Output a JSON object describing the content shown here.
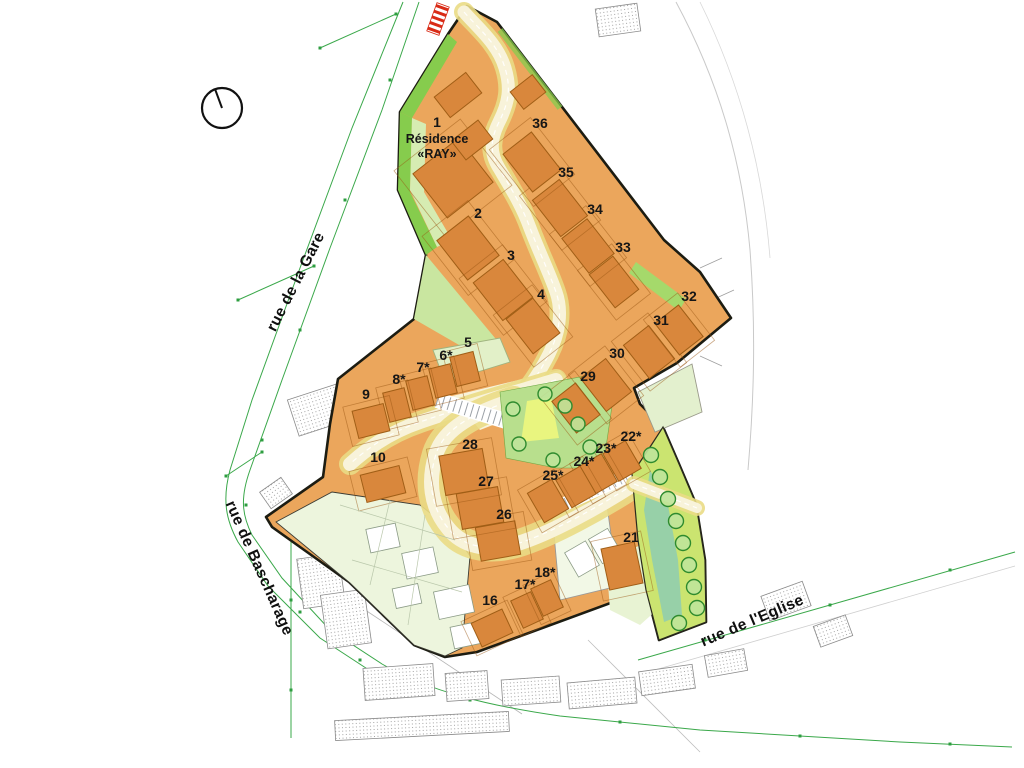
{
  "map": {
    "colors": {
      "lot_fill": "#EBA65C",
      "building_fill": "#D9873C",
      "building_stroke": "#A05E16",
      "boundary": "#1c1c12",
      "road_edge": "#EADB85",
      "road_fill": "#F8F3DA",
      "green_bright": "#86CC4D",
      "green_light": "#C9E6A0",
      "green_central": "#B8DF8D",
      "green_yellow_patch": "#E9F57F",
      "strip_fill": "#CBE470",
      "strip_teal": "#8FCDAF",
      "faint_lot": "#EDF5DD",
      "marker_red": "#D92B16",
      "survey_green": "#3aa84a"
    },
    "compass": {
      "cx": 222,
      "cy": 108,
      "r": 20,
      "hand_x": 215,
      "hand_y": 89
    },
    "entrance_marker": {
      "x": 438,
      "y": 19,
      "w": 13,
      "h": 30,
      "rot": 20,
      "stripes": 5
    },
    "residence": {
      "lot": "1",
      "line1": "Résidence",
      "line2": "«RAY»",
      "x": 437,
      "y1": 143,
      "y2": 158
    },
    "streets": [
      {
        "id": "gare",
        "name": "rue de la Gare",
        "x": 300,
        "y": 284,
        "rot": -63
      },
      {
        "id": "bascharage",
        "name": "rue de Bascharage",
        "x": 255,
        "y": 570,
        "rot": 66
      },
      {
        "id": "eglise",
        "name": "rue de l'Eglise",
        "x": 754,
        "y": 625,
        "rot": -23
      }
    ],
    "boundary": "467,6 497,22 664,240 700,272 731,318 677,363 634,388 640,404 663,427 679,464 696,504 705,560 706,622 659,640 646,590 477,652 445,657 414,645 349,582 272,527 266,517 323,477 330,424 338,379 414,319 426,255 398,190 400,112 448,34",
    "plaza": "452,396 560,370 578,392 480,430",
    "roads": [
      {
        "d": "M464,12 C478,28 498,44 505,68 C511,88 509,102 499,122 C491,138 489,152 499,168 C512,190 522,206 530,228 C540,254 549,272 556,292 C563,312 559,334 549,354 C541,370 532,384 520,398",
        "w1": 16,
        "w2": 11,
        "over": false
      },
      {
        "d": "M556,380 C510,394 460,408 420,422 C396,430 372,444 350,464",
        "w1": 18,
        "w2": 12,
        "over": false
      },
      {
        "d": "M514,400 C476,412 444,428 436,454 C428,480 430,506 448,528 C462,546 486,552 516,544 C550,534 600,506 634,484",
        "w1": 24,
        "w2": 13,
        "over": false
      },
      {
        "d": "M634,484 L697,508",
        "w1": 12,
        "w2": 8,
        "over": true
      }
    ],
    "greens": [
      {
        "pts": "400,112 398,190 426,255 437,247 410,192 412,118",
        "fill": "#86CC4D"
      },
      {
        "pts": "448,34 400,112 412,118 457,42",
        "fill": "#86CC4D"
      },
      {
        "pts": "412,118 410,190 437,247 452,240 424,192 426,124",
        "fill": "#D6ECB2"
      },
      {
        "pts": "426,255 505,350 492,364 414,319",
        "fill": "#C9E6A0"
      },
      {
        "pts": "636,262 686,299 679,311 629,273",
        "fill": "#A5D96B"
      },
      {
        "pts": "433,350 500,338 510,362 445,382",
        "fill": "#E2F0C8",
        "stroke": "#9fb37f"
      },
      {
        "pts": "606,558 655,540 668,600 640,625 610,610",
        "fill": "#E8F3D3"
      },
      {
        "pts": "638,392 692,364 702,412 655,432",
        "fill": "#E3F0CE",
        "stroke": "#9a9a8a"
      },
      {
        "pts": "276,522 332,492 420,505 452,530 470,556 462,648 445,656 414,645 350,583",
        "fill": "#EDF5DD",
        "stroke": "#3c3c34"
      },
      {
        "pts": "552,512 606,498 618,586 560,600",
        "fill": "#F2F8E6",
        "stroke": "#999999"
      }
    ],
    "green_lines": [
      {
        "d": "M500,30 L560,108",
        "stroke": "#86CC4D",
        "w": 6,
        "o": 0.75
      }
    ],
    "central_green": {
      "pts": "500,392 596,374 614,392 603,468 556,468 506,458",
      "yellow": "527,401 551,397 559,438 521,442"
    },
    "strip": {
      "pts": "632,474 652,444 663,427 679,464 696,504 705,560 706,622 659,640 646,590 638,540",
      "teal": "650,470 668,505 678,560 682,615 664,622 652,560 644,510"
    },
    "trees": {
      "central": [
        [
          545,
          394
        ],
        [
          513,
          409
        ],
        [
          565,
          406
        ],
        [
          578,
          424
        ],
        [
          519,
          444
        ],
        [
          590,
          447
        ],
        [
          553,
          460
        ]
      ],
      "strip": [
        [
          651,
          455
        ],
        [
          660,
          477
        ],
        [
          668,
          499
        ],
        [
          676,
          521
        ],
        [
          683,
          543
        ],
        [
          689,
          565
        ],
        [
          694,
          587
        ],
        [
          697,
          608
        ],
        [
          679,
          623
        ]
      ]
    },
    "lots": [
      {
        "label": "1",
        "lx": 437,
        "ly": 127,
        "bx": 453,
        "by": 178,
        "bw": 56,
        "bh": 58,
        "rot": 52
      },
      {
        "label": "2",
        "lx": 478,
        "ly": 218,
        "bx": 468,
        "by": 248,
        "bw": 50,
        "bh": 40,
        "rot": 52
      },
      {
        "label": "3",
        "lx": 511,
        "ly": 260,
        "bx": 503,
        "by": 290,
        "bw": 48,
        "bh": 38,
        "rot": 52
      },
      {
        "label": "4",
        "lx": 541,
        "ly": 299,
        "bx": 533,
        "by": 326,
        "bw": 44,
        "bh": 34,
        "rot": 52
      },
      {
        "label": "5",
        "lx": 468,
        "ly": 347,
        "bx": 465,
        "by": 369,
        "bw": 24,
        "bh": 30,
        "rot": -14
      },
      {
        "label": "6*",
        "lx": 446,
        "ly": 360,
        "bx": 443,
        "by": 381,
        "bw": 22,
        "bh": 30,
        "rot": -14
      },
      {
        "label": "7*",
        "lx": 423,
        "ly": 372,
        "bx": 420,
        "by": 393,
        "bw": 22,
        "bh": 30,
        "rot": -14
      },
      {
        "label": "8*",
        "lx": 399,
        "ly": 384,
        "bx": 397,
        "by": 405,
        "bw": 22,
        "bh": 30,
        "rot": -14
      },
      {
        "label": "9",
        "lx": 366,
        "ly": 399,
        "bx": 371,
        "by": 421,
        "bw": 32,
        "bh": 28,
        "rot": -14
      },
      {
        "label": "10",
        "lx": 378,
        "ly": 462,
        "bx": 383,
        "by": 484,
        "bw": 40,
        "bh": 28,
        "rot": -14
      },
      {
        "label": "16",
        "lx": 490,
        "ly": 605,
        "bx": 492,
        "by": 628,
        "bw": 34,
        "bh": 26,
        "rot": -25
      },
      {
        "label": "17*",
        "lx": 525,
        "ly": 589,
        "bx": 527,
        "by": 610,
        "bw": 22,
        "bh": 30,
        "rot": -25
      },
      {
        "label": "18*",
        "lx": 545,
        "ly": 577,
        "bx": 547,
        "by": 598,
        "bw": 22,
        "bh": 30,
        "rot": -25
      },
      {
        "label": "21",
        "lx": 631,
        "ly": 542,
        "bx": 622,
        "by": 566,
        "bw": 34,
        "bh": 42,
        "rot": -12
      },
      {
        "label": "22*",
        "lx": 631,
        "ly": 441,
        "bx": 622,
        "by": 461,
        "bw": 26,
        "bh": 32,
        "rot": -30
      },
      {
        "label": "23*",
        "lx": 606,
        "ly": 453,
        "bx": 598,
        "by": 474,
        "bw": 26,
        "bh": 32,
        "rot": -30
      },
      {
        "label": "24*",
        "lx": 584,
        "ly": 466,
        "bx": 576,
        "by": 487,
        "bw": 28,
        "bh": 32,
        "rot": -30
      },
      {
        "label": "25*",
        "lx": 553,
        "ly": 480,
        "bx": 548,
        "by": 501,
        "bw": 28,
        "bh": 34,
        "rot": -30
      },
      {
        "label": "26",
        "lx": 504,
        "ly": 519,
        "bx": 498,
        "by": 541,
        "bw": 40,
        "bh": 34,
        "rot": -10
      },
      {
        "label": "27",
        "lx": 486,
        "ly": 486,
        "bx": 480,
        "by": 508,
        "bw": 42,
        "bh": 36,
        "rot": -10
      },
      {
        "label": "28",
        "lx": 470,
        "ly": 449,
        "bx": 464,
        "by": 472,
        "bw": 44,
        "bh": 40,
        "rot": -10
      },
      {
        "label": "29",
        "lx": 588,
        "ly": 381,
        "bx": 576,
        "by": 408,
        "bw": 40,
        "bh": 30,
        "rot": 52
      },
      {
        "label": "30",
        "lx": 617,
        "ly": 358,
        "bx": 606,
        "by": 385,
        "bw": 42,
        "bh": 32,
        "rot": 52
      },
      {
        "label": "31",
        "lx": 661,
        "ly": 325,
        "bx": 649,
        "by": 352,
        "bw": 42,
        "bh": 32,
        "rot": 52
      },
      {
        "label": "32",
        "lx": 689,
        "ly": 301,
        "bx": 679,
        "by": 330,
        "bw": 40,
        "bh": 30,
        "rot": 52
      },
      {
        "label": "33",
        "lx": 623,
        "ly": 252,
        "bx": 614,
        "by": 282,
        "bw": 42,
        "bh": 30,
        "rot": 52
      },
      {
        "label": "34",
        "lx": 595,
        "ly": 214,
        "bx": 588,
        "by": 246,
        "bw": 44,
        "bh": 32,
        "rot": 52
      },
      {
        "label": "35",
        "lx": 566,
        "ly": 177,
        "bx": 560,
        "by": 208,
        "bw": 46,
        "bh": 34,
        "rot": 52
      },
      {
        "label": "36",
        "lx": 540,
        "ly": 128,
        "bx": 532,
        "by": 162,
        "bw": 48,
        "bh": 36,
        "rot": 52
      }
    ],
    "extra_buildings": [
      [
        458,
        95,
        26,
        40,
        52
      ],
      [
        472,
        140,
        24,
        34,
        52
      ],
      [
        528,
        92,
        22,
        28,
        52
      ]
    ],
    "faint_buildings": [
      [
        383,
        538,
        30,
        24,
        -12
      ],
      [
        420,
        563,
        32,
        26,
        -12
      ],
      [
        454,
        602,
        36,
        28,
        -12
      ],
      [
        467,
        635,
        30,
        22,
        -12
      ],
      [
        407,
        596,
        26,
        20,
        -12
      ],
      [
        582,
        559,
        24,
        28,
        -30
      ],
      [
        605,
        546,
        22,
        28,
        -30
      ]
    ],
    "existing_buildings": [
      [
        618,
        20,
        42,
        28,
        -8
      ],
      [
        318,
        410,
        52,
        38,
        -18
      ],
      [
        276,
        493,
        26,
        20,
        -35
      ],
      [
        302,
        523,
        26,
        20,
        -35
      ],
      [
        321,
        581,
        42,
        50,
        -8
      ],
      [
        346,
        619,
        44,
        54,
        -8
      ],
      [
        399,
        682,
        70,
        32,
        -4
      ],
      [
        467,
        686,
        42,
        28,
        -4
      ],
      [
        531,
        691,
        58,
        26,
        -4
      ],
      [
        422,
        726,
        174,
        20,
        -3
      ],
      [
        602,
        693,
        68,
        26,
        -5
      ],
      [
        667,
        680,
        54,
        24,
        -8
      ],
      [
        726,
        663,
        40,
        22,
        -10
      ],
      [
        786,
        601,
        44,
        26,
        -20
      ],
      [
        833,
        631,
        34,
        22,
        -20
      ]
    ]
  }
}
